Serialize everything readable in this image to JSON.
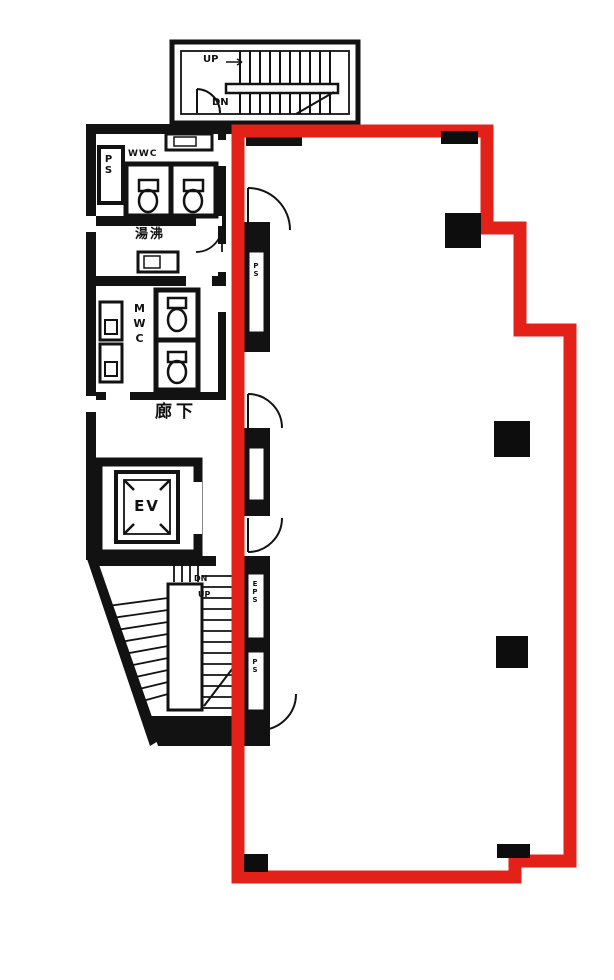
{
  "meta": {
    "type": "building-floor-plan-with-highlighted-unit",
    "highlight_color": "#e32119",
    "wall_color": "#121212",
    "background_color": "#ffffff"
  },
  "labels": {
    "top_stairs": {
      "up": "UP",
      "down": "DN"
    },
    "pipe_shaft": "PS",
    "womens_wc": "WWC",
    "hot_water_room": "湯沸",
    "mens_wc": "MWC",
    "corridor": "廊下",
    "elevator": "EV",
    "bottom_stairs": {
      "down": "DN",
      "up": "UP"
    },
    "wall_shafts": {
      "shaft_a": "PS",
      "shaft_b": "EPS",
      "shaft_c": "PS"
    }
  }
}
